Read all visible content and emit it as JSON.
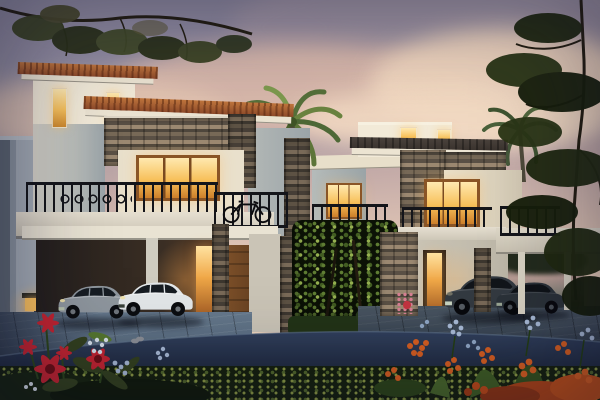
{
  "scene": {
    "type": "architectural dusk rendering",
    "subject": "Two modern two-storey villas with stone cladding, terracotta and dark flat roofs, warm lit windows, carports with parked sedans, palm trees and flowering gardens along a curved street at twilight",
    "time_of_day": "dusk",
    "villa_count": 2,
    "cars": [
      {
        "position": "left carport",
        "color_name": "silver"
      },
      {
        "position": "left carport",
        "color_name": "white"
      },
      {
        "position": "right carport",
        "color_name": "dark grey"
      },
      {
        "position": "right carport",
        "color_name": "dark grey"
      }
    ],
    "lit_windows": true,
    "foreground": "red, orange and blue flowers with green hedge",
    "street": "dark asphalt road curving across the foreground"
  },
  "colors": {
    "sky_top": "#8b8fa2",
    "sky_mid": "#c4aba8",
    "sky_low": "#ecd0ba",
    "sky_glow": "#f6e2c8",
    "cloud_grey": "#938da3",
    "cloud_pink": "#e2bead",
    "cloud_cream": "#f3d8c0",
    "wall_light": "#f2ead8",
    "wall_cream": "#e9e0cc",
    "wall_shade": "#b7bcba",
    "wall_dark": "#8b949c",
    "roof_tile": "#8e4a2a",
    "roof_tile_light": "#c1763d",
    "roof_dark": "#3a332e",
    "stone_dark": "#4e463c",
    "stone_mid": "#776957",
    "stone_light": "#9b8871",
    "window_glow": "#f7c05a",
    "window_glow_light": "#ffe9b0",
    "window_frame": "#8a5526",
    "railing": "#14151a",
    "wood_door": "#6b4423",
    "car_silver": "#8f979e",
    "car_white": "#e3e7e9",
    "car_dark": "#333a41",
    "car_dark2": "#2b3238",
    "glass_dark": "#161c22",
    "road_light": "#31405c",
    "road_dark": "#121a28",
    "paver": "#5c6f82",
    "foliage_dark": "#20290f",
    "foliage_mid": "#33411d",
    "foliage_light": "#5f7d33",
    "hedge_green": "#8d9c43",
    "flower_red": "#c62430",
    "flower_orange": "#d95f1f",
    "flower_blue": "#a9bbd6",
    "lamp_glow": "#ffc45f"
  }
}
